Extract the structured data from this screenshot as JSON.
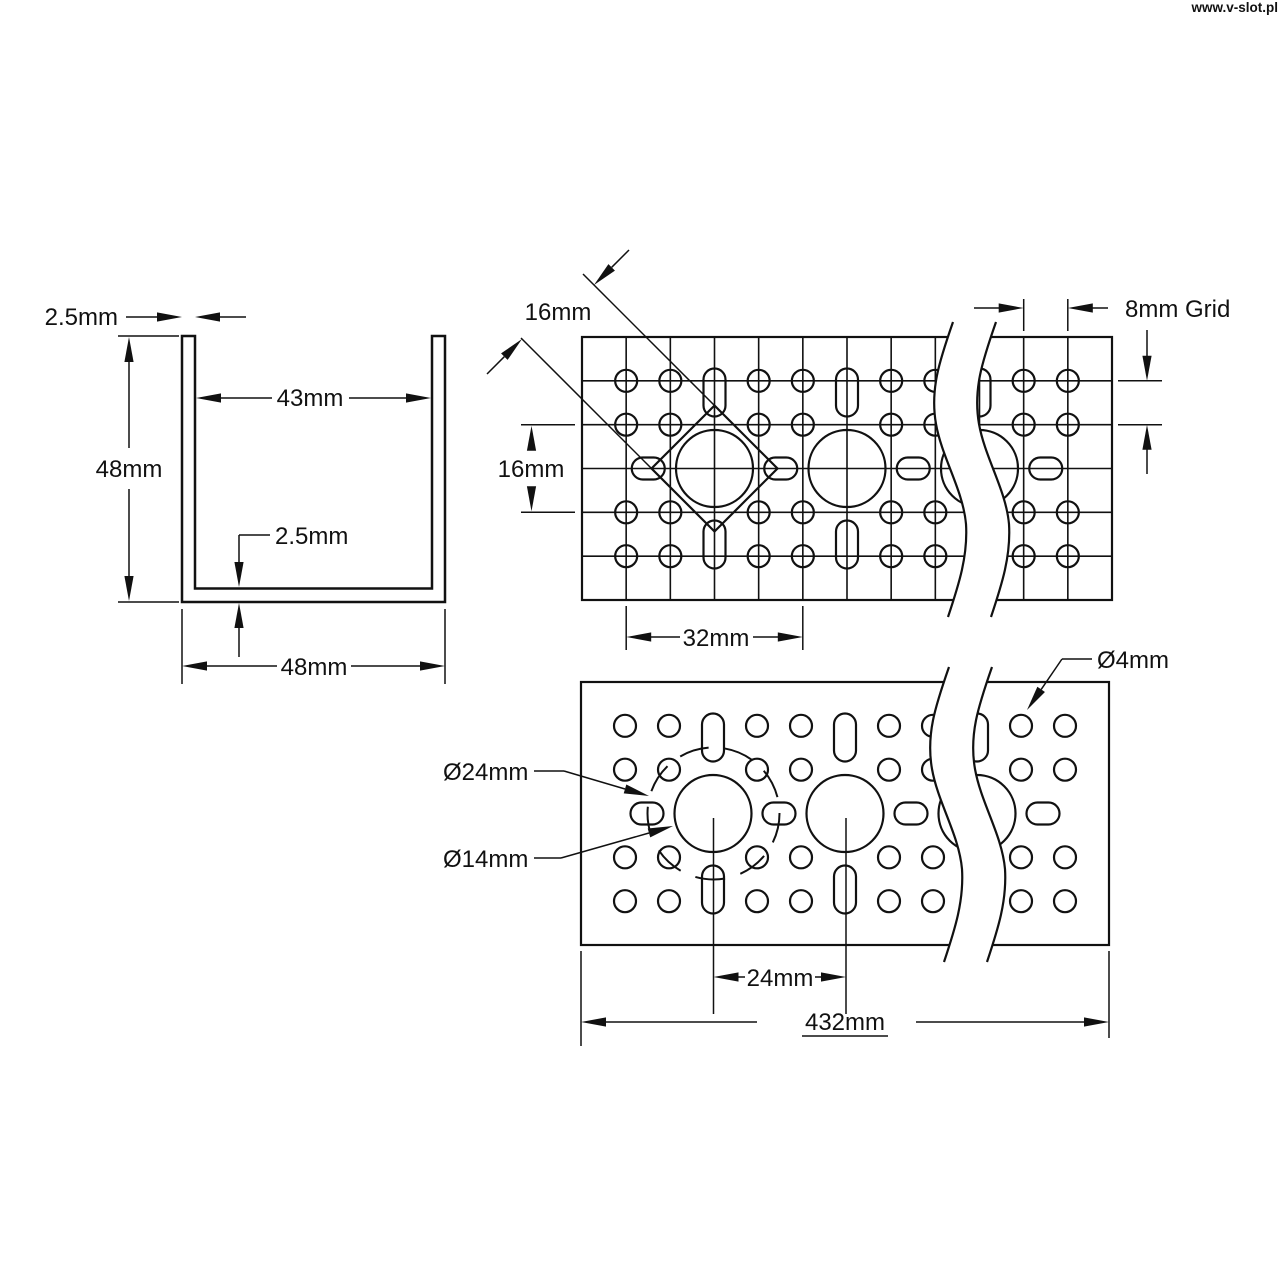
{
  "watermark": "www.v-slot.pl",
  "cross_section_view": {
    "top_wall_thickness": "2.5mm",
    "inner_width": "43mm",
    "outer_height": "48mm",
    "bottom_wall_thickness": "2.5mm",
    "outer_width": "48mm"
  },
  "face_view": {
    "square_pattern_size": "16mm",
    "row_pair_spacing": "16mm",
    "hole_group_spacing": "32mm",
    "grid_spacing_label": "8mm Grid"
  },
  "plate_view": {
    "small_hole_diameter": "Ø4mm",
    "bolt_circle_diameter": "Ø24mm",
    "center_hole_diameter": "Ø14mm",
    "center_hole_spacing": "24mm",
    "overall_length": "432mm"
  },
  "colors": {
    "line": "#111111",
    "background": "#ffffff"
  }
}
